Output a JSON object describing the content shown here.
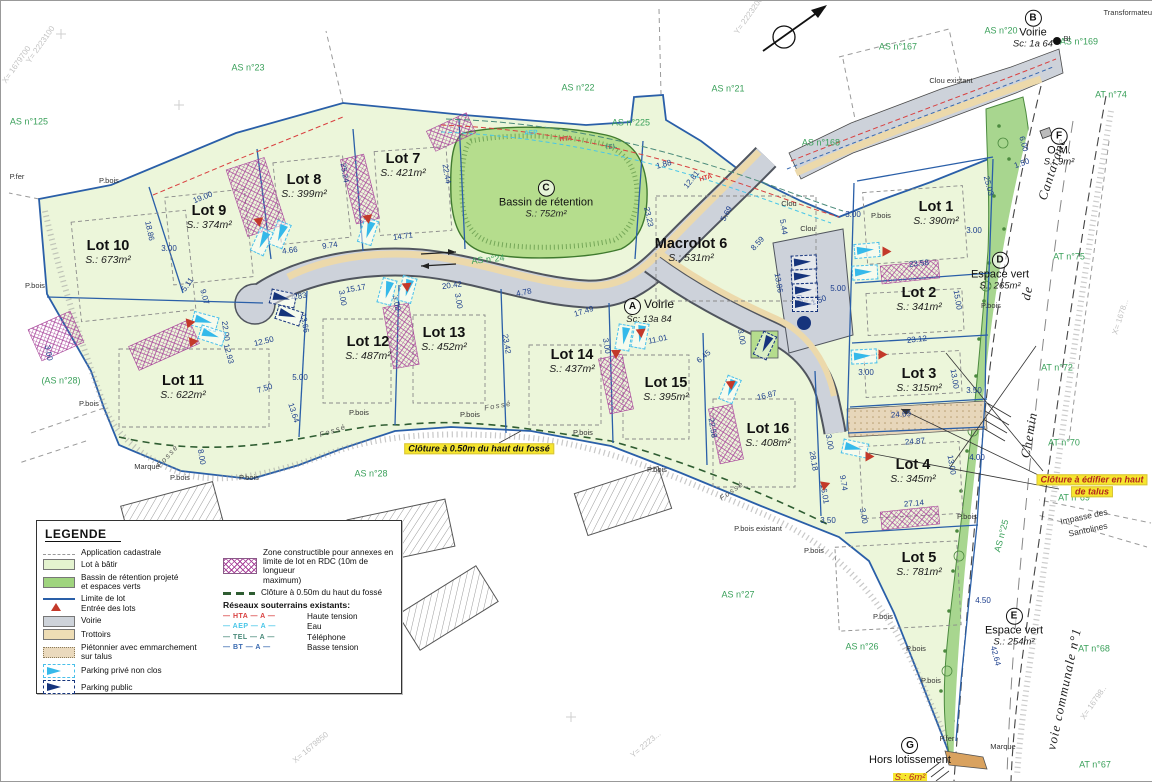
{
  "map": {
    "lots": [
      {
        "name": "Lot 1",
        "area": "S.: 390m²",
        "x": 935,
        "y": 212
      },
      {
        "name": "Lot 2",
        "area": "S.: 341m²",
        "x": 918,
        "y": 298
      },
      {
        "name": "Lot 3",
        "area": "S.: 315m²",
        "x": 918,
        "y": 379
      },
      {
        "name": "Lot 4",
        "area": "S.: 345m²",
        "x": 912,
        "y": 470
      },
      {
        "name": "Lot 5",
        "area": "S.: 781m²",
        "x": 918,
        "y": 563
      },
      {
        "name": "Macrolot 6",
        "area": "S.: 531m²",
        "x": 690,
        "y": 249
      },
      {
        "name": "Lot 7",
        "area": "S.: 421m²",
        "x": 402,
        "y": 164
      },
      {
        "name": "Lot 8",
        "area": "S.: 399m²",
        "x": 303,
        "y": 185
      },
      {
        "name": "Lot 9",
        "area": "S.: 374m²",
        "x": 208,
        "y": 216
      },
      {
        "name": "Lot 10",
        "area": "S.: 673m²",
        "x": 107,
        "y": 251
      },
      {
        "name": "Lot 11",
        "area": "S.: 622m²",
        "x": 182,
        "y": 386
      },
      {
        "name": "Lot 12",
        "area": "S.: 487m²",
        "x": 367,
        "y": 347
      },
      {
        "name": "Lot 13",
        "area": "S.: 452m²",
        "x": 443,
        "y": 338
      },
      {
        "name": "Lot 14",
        "area": "S.: 437m²",
        "x": 571,
        "y": 360
      },
      {
        "name": "Lot 15",
        "area": "S.: 395m²",
        "x": 665,
        "y": 388
      },
      {
        "name": "Lot 16",
        "area": "S.: 408m²",
        "x": 767,
        "y": 434
      }
    ],
    "features": [
      {
        "letter": "C",
        "label": "Bassin de rétention",
        "area": "S.: 752m²",
        "x": 545,
        "y": 198,
        "layout": "stack"
      },
      {
        "letter": "A",
        "label": "Voirie",
        "area": "Sc: 13a 84",
        "x": 648,
        "y": 310,
        "layout": "inline"
      },
      {
        "letter": "B",
        "label": "Voirie",
        "area": "Sc: 1a 64",
        "x": 1032,
        "y": 28,
        "layout": "stack"
      },
      {
        "letter": "D",
        "label": "Espace vert",
        "area": "S.: 265m²",
        "x": 999,
        "y": 270,
        "layout": "stack"
      },
      {
        "letter": "E",
        "label": "Espace vert",
        "area": "S.: 254m²",
        "x": 1013,
        "y": 626,
        "layout": "stack"
      },
      {
        "letter": "F",
        "label": "O.M.",
        "area": "S.: 9m²",
        "x": 1058,
        "y": 146,
        "layout": "stack"
      },
      {
        "letter": "G",
        "label": "Hors lotissement",
        "area": "S.: 6m²",
        "x": 909,
        "y": 759,
        "layout": "stack",
        "hl": true
      }
    ],
    "parcel_refs": [
      {
        "t": "AS n°125",
        "x": 28,
        "y": 121
      },
      {
        "t": "AS n°23",
        "x": 247,
        "y": 67
      },
      {
        "t": "AS n°22",
        "x": 577,
        "y": 87
      },
      {
        "t": "AS n°21",
        "x": 727,
        "y": 88
      },
      {
        "t": "AS n°225",
        "x": 630,
        "y": 122
      },
      {
        "t": "AS n°20",
        "x": 1000,
        "y": 30
      },
      {
        "t": "AS n°167",
        "x": 897,
        "y": 46
      },
      {
        "t": "AS n°168",
        "x": 820,
        "y": 142
      },
      {
        "t": "AS n°169",
        "x": 1078,
        "y": 41
      },
      {
        "t": "AT n°74",
        "x": 1110,
        "y": 94
      },
      {
        "t": "AT n°75",
        "x": 1068,
        "y": 256
      },
      {
        "t": "AT n°72",
        "x": 1056,
        "y": 367
      },
      {
        "t": "AT n°70",
        "x": 1063,
        "y": 442
      },
      {
        "t": "AT n°69",
        "x": 1073,
        "y": 497
      },
      {
        "t": "AT n°68",
        "x": 1093,
        "y": 648
      },
      {
        "t": "AT n°67",
        "x": 1094,
        "y": 764
      },
      {
        "t": "(AS n°28)",
        "x": 60,
        "y": 380
      },
      {
        "t": "AS n°28",
        "x": 370,
        "y": 473
      },
      {
        "t": "AS n°27",
        "x": 737,
        "y": 594
      },
      {
        "t": "AS n°26",
        "x": 861,
        "y": 646
      },
      {
        "t": "AS n°25",
        "x": 1001,
        "y": 535,
        "rot": -75
      },
      {
        "t": "AS n°24",
        "x": 487,
        "y": 259,
        "rot": -6
      }
    ],
    "road_names": [
      {
        "t": "Cantarane",
        "x": 1051,
        "y": 168,
        "rot": -72
      },
      {
        "t": "de",
        "x": 1026,
        "y": 292,
        "rot": -78
      },
      {
        "t": "Chemin",
        "x": 1028,
        "y": 434,
        "rot": -80
      },
      {
        "t": "voie communale n°1",
        "x": 1063,
        "y": 688,
        "rot": -78
      },
      {
        "t": "Impasse des",
        "x": 1083,
        "y": 516,
        "rot": -12,
        "cls": "road-sm"
      },
      {
        "t": "Santolines",
        "x": 1087,
        "y": 529,
        "rot": -12,
        "cls": "road-sm"
      }
    ],
    "notes": [
      {
        "t": "Clôture à 0.50m du haut du fossé",
        "x": 478,
        "y": 448,
        "cls": ""
      },
      {
        "t": "Clôture à édifier en haut",
        "x": 1091,
        "y": 479,
        "cls": "note-red"
      },
      {
        "t": "de talus",
        "x": 1091,
        "y": 491,
        "cls": "note-red"
      }
    ],
    "dims": [
      [
        "19.00",
        202,
        197,
        -22
      ],
      [
        "18.86",
        148,
        230,
        78
      ],
      [
        "3.00",
        168,
        248,
        0
      ],
      [
        "25.24",
        343,
        172,
        80
      ],
      [
        "22.44",
        445,
        173,
        80
      ],
      [
        "14.71",
        402,
        236,
        -8
      ],
      [
        "9.74",
        329,
        245,
        -8
      ],
      [
        "4.66",
        289,
        250,
        -8
      ],
      [
        "4.83",
        298,
        296,
        -10
      ],
      [
        "15.17",
        355,
        288,
        -10
      ],
      [
        "13.66",
        303,
        322,
        80
      ],
      [
        "20.42",
        451,
        285,
        -8
      ],
      [
        "4.78",
        523,
        292,
        -12
      ],
      [
        "17.49",
        583,
        311,
        -18
      ],
      [
        "23.42",
        505,
        343,
        80
      ],
      [
        "23.23",
        647,
        216,
        78
      ],
      [
        "12.81",
        691,
        179,
        -52
      ],
      [
        "5.69",
        726,
        213,
        -62
      ],
      [
        "8.59",
        757,
        243,
        -48
      ],
      [
        "5.44",
        782,
        226,
        80
      ],
      [
        "1.88",
        663,
        164,
        -15
      ],
      [
        "13.86",
        777,
        282,
        80
      ],
      [
        "5.00",
        797,
        295,
        80
      ],
      [
        "5.00",
        837,
        288,
        0
      ],
      [
        "1.50",
        818,
        300,
        -20
      ],
      [
        "11.01",
        657,
        339,
        -12
      ],
      [
        "6.45",
        703,
        356,
        -40
      ],
      [
        "16.87",
        766,
        395,
        -14
      ],
      [
        "22.58",
        711,
        427,
        80
      ],
      [
        "28.18",
        812,
        460,
        80
      ],
      [
        "16.01",
        823,
        493,
        80
      ],
      [
        "3.50",
        827,
        520,
        0
      ],
      [
        "25.03",
        987,
        185,
        75
      ],
      [
        "23.58",
        918,
        263,
        -6
      ],
      [
        "15.00",
        956,
        299,
        80
      ],
      [
        "23.12",
        916,
        339,
        -6
      ],
      [
        "13.00",
        953,
        378,
        80
      ],
      [
        "3.50",
        973,
        390,
        0
      ],
      [
        "24.69",
        900,
        414,
        -5
      ],
      [
        "24.87",
        914,
        441,
        -5
      ],
      [
        "13.00",
        950,
        464,
        80
      ],
      [
        "4.00",
        976,
        457,
        0
      ],
      [
        "27.14",
        913,
        503,
        -5
      ],
      [
        "9.74",
        842,
        482,
        80
      ],
      [
        "4.50",
        982,
        600,
        0
      ],
      [
        "42.64",
        994,
        655,
        75
      ],
      [
        "12.50",
        263,
        341,
        -14
      ],
      [
        "12.93",
        227,
        353,
        75
      ],
      [
        "7.50",
        264,
        388,
        -18
      ],
      [
        "5.00",
        299,
        377,
        0
      ],
      [
        "13.64",
        292,
        412,
        72
      ],
      [
        "8.00",
        200,
        456,
        80
      ],
      [
        "5.11",
        187,
        284,
        -55
      ],
      [
        "9.07",
        203,
        296,
        75
      ],
      [
        "22.00",
        224,
        330,
        82
      ],
      [
        "3.00",
        47,
        352,
        80
      ],
      [
        "3.00",
        341,
        297,
        80
      ],
      [
        "3.00",
        605,
        345,
        80
      ],
      [
        "3.00",
        740,
        336,
        80
      ],
      [
        "3.00",
        865,
        372,
        0
      ],
      [
        "3.00",
        852,
        214,
        0
      ],
      [
        "3.00",
        973,
        230,
        0
      ],
      [
        "3.00",
        828,
        441,
        80
      ],
      [
        "3.00",
        862,
        515,
        80
      ],
      [
        "6.00",
        1022,
        143,
        75
      ],
      [
        "1.50",
        1021,
        163,
        -20
      ],
      [
        "3.00",
        395,
        302,
        80
      ],
      [
        "3.00",
        457,
        300,
        80
      ]
    ],
    "small_labels": [
      [
        "P.fer",
        16,
        176
      ],
      [
        "P.bois",
        108,
        180
      ],
      [
        "P.bois",
        34,
        285
      ],
      [
        "P.bois",
        88,
        403
      ],
      [
        "Marque",
        146,
        466
      ],
      [
        "P.bois",
        179,
        477
      ],
      [
        "P.bois",
        248,
        477
      ],
      [
        "P.bois",
        358,
        412
      ],
      [
        "P.bois",
        469,
        414
      ],
      [
        "P.bois",
        582,
        432
      ],
      [
        "P.bois",
        656,
        469
      ],
      [
        "P.bois existant",
        757,
        528
      ],
      [
        "P.bois",
        813,
        550
      ],
      [
        "P.bois",
        880,
        215
      ],
      [
        "P.bois",
        990,
        305
      ],
      [
        "P.bois",
        966,
        516
      ],
      [
        "P.bois",
        882,
        616
      ],
      [
        "P.bois",
        915,
        648
      ],
      [
        "P.bois",
        930,
        680
      ],
      [
        "P.fer",
        946,
        738
      ],
      [
        "Marque",
        1002,
        746
      ],
      [
        "Clou",
        788,
        203
      ],
      [
        "Clou",
        807,
        228
      ],
      [
        "Clou existant",
        950,
        80
      ],
      [
        "BI",
        1066,
        38
      ],
      [
        "Transformateur",
        1128,
        12
      ]
    ],
    "fosse_labels": [
      [
        "Fossé",
        167,
        455,
        -48
      ],
      [
        "Fossé",
        332,
        430,
        -18
      ],
      [
        "Fossé",
        497,
        405,
        -10
      ],
      [
        "Fossé",
        731,
        490,
        -35
      ]
    ],
    "net_labels": [
      [
        "HTA",
        565,
        139,
        -6,
        "#d94040"
      ],
      [
        "AEP",
        530,
        133,
        -4,
        "#49c6e8"
      ],
      [
        "TEL",
        610,
        147,
        -8,
        "#4a8a7a"
      ],
      [
        "HTA",
        705,
        178,
        -16,
        "#d94040"
      ]
    ],
    "coord_labels": [
      [
        "Y= 2223100",
        40,
        44,
        -55
      ],
      [
        "X= 1679700",
        16,
        64,
        -55
      ],
      [
        "Y= 2223200",
        748,
        15,
        -55
      ],
      [
        "X= 1679850",
        310,
        747,
        -40
      ],
      [
        "Y= 2223...",
        645,
        744,
        -40
      ],
      [
        "X= 1678...",
        1120,
        316,
        -72
      ],
      [
        "X= 16798..",
        1093,
        702,
        -55
      ]
    ],
    "parking_prive": [
      [
        260,
        240,
        115
      ],
      [
        278,
        233,
        112
      ],
      [
        366,
        230,
        108
      ],
      [
        385,
        290,
        105
      ],
      [
        405,
        288,
        105
      ],
      [
        622,
        336,
        100
      ],
      [
        638,
        334,
        100
      ],
      [
        728,
        388,
        112
      ],
      [
        865,
        249,
        -5
      ],
      [
        863,
        271,
        -3
      ],
      [
        862,
        355,
        -3
      ],
      [
        853,
        447,
        12
      ],
      [
        203,
        320,
        15
      ],
      [
        210,
        334,
        18
      ]
    ],
    "parking_public": [
      [
        802,
        261,
        -3
      ],
      [
        802,
        275,
        -3
      ],
      [
        803,
        289,
        -2
      ],
      [
        803,
        303,
        0
      ],
      [
        763,
        344,
        115
      ],
      [
        281,
        297,
        12
      ],
      [
        287,
        314,
        18
      ]
    ],
    "entries": [
      [
        886,
        251,
        90
      ],
      [
        882,
        354,
        90
      ],
      [
        869,
        456,
        90
      ],
      [
        615,
        354,
        180
      ],
      [
        258,
        222,
        170
      ],
      [
        367,
        219,
        170
      ],
      [
        406,
        287,
        175
      ],
      [
        640,
        333,
        175
      ],
      [
        730,
        385,
        175
      ],
      [
        825,
        484,
        70
      ],
      [
        190,
        322,
        80
      ],
      [
        193,
        341,
        82
      ]
    ]
  },
  "legend": {
    "title": "LEGENDE",
    "items_left": [
      {
        "sw": "cadastre",
        "label": "Application cadastrale"
      },
      {
        "sw": "lot",
        "label": "Lot à bâtir"
      },
      {
        "sw": "basin",
        "label": "Bassin de rétention projeté\net espaces verts"
      },
      {
        "sw": "limite",
        "label": "Limite de lot\nEntrée des lots"
      },
      {
        "sw": "voirie",
        "label": "Voirie"
      },
      {
        "sw": "trottoirs",
        "label": "Trottoirs"
      },
      {
        "sw": "pieton",
        "label": "Piétonnier avec emmarchement\nsur talus"
      },
      {
        "sw": "pprive",
        "label": "Parking privé non clos"
      },
      {
        "sw": "ppublic",
        "label": "Parking public"
      }
    ],
    "items_right": [
      {
        "sw": "zone",
        "label": "Zone constructible pour annexes en\nlimite de lot en RDC (10m de longueur\nmaximum)"
      },
      {
        "sw": "cloture",
        "label": "Clôture à 0.50m du haut du fossé"
      }
    ],
    "networks_title": "Réseaux souterrains existants:",
    "networks": [
      {
        "code": "HTA",
        "label": "Haute tension",
        "color": "#d94040"
      },
      {
        "code": "AEP",
        "label": "Eau",
        "color": "#49c6e8"
      },
      {
        "code": "TEL",
        "label": "Téléphone",
        "color": "#4a8a7a"
      },
      {
        "code": "BT",
        "label": "Basse tension",
        "color": "#3a6ab0"
      }
    ]
  },
  "colors": {
    "site_fill": "#ecf6da",
    "basin_fill": "#b5dd8d",
    "green_strip": "#a8d68f",
    "road": "#cdd2da",
    "trottoir": "#ecd9ab",
    "lot_line": "#2a5fa8",
    "hatch": "#a8439a",
    "entry_red": "#c3392a",
    "parking_prive": "#35b9ea",
    "parking_public": "#16347c",
    "note_yellow": "#f6e62e",
    "ref_green": "#3aa05a"
  }
}
